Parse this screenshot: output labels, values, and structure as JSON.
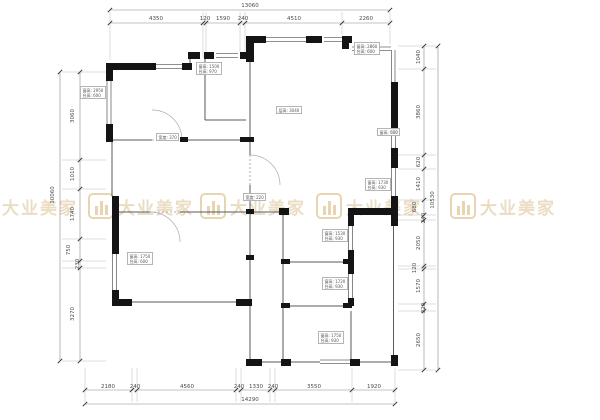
{
  "watermark": {
    "text": "大业美家",
    "color": "#dcc293"
  },
  "colors": {
    "walls": "#141414",
    "dimension_text": "#4a4a4a",
    "watermark": "#dcc293"
  },
  "dimensions": {
    "top": {
      "total": "13060",
      "segments": [
        "4350",
        "120",
        "1590",
        "240",
        "4510",
        "2260"
      ]
    },
    "bottom": {
      "total": "14290",
      "segments": [
        "2180",
        "240",
        "4560",
        "240",
        "1330",
        "240",
        "3550",
        "1920"
      ]
    },
    "left": {
      "total": "10060",
      "segments": [
        "3060",
        "1010",
        "1740",
        "750",
        "230",
        "3270"
      ]
    },
    "right": {
      "total": "10530",
      "segments": [
        "1040",
        "3860",
        "620",
        "1410",
        "680",
        "240",
        "2050",
        "120",
        "1570",
        "320",
        "2650"
      ]
    }
  },
  "annotations": [
    {
      "id": "window-left-upper",
      "lines": [
        "窗高: 2950",
        "台高: 600"
      ]
    },
    {
      "id": "window-top-middle",
      "lines": [
        "窗高: 1500",
        "台高: 970"
      ]
    },
    {
      "id": "window-top-right",
      "lines": [
        "窗高: 2860",
        "台高: 600"
      ]
    },
    {
      "id": "living-room-height",
      "lines": [
        "层高: 3040"
      ]
    },
    {
      "id": "window-right-upper",
      "lines": [
        "窗高: 600"
      ]
    },
    {
      "id": "opening-width-a",
      "lines": [
        "宽度: 370"
      ]
    },
    {
      "id": "opening-width-b",
      "lines": [
        "宽度: 220"
      ]
    },
    {
      "id": "window-right-mid",
      "lines": [
        "窗高: 1730",
        "台高: 930"
      ]
    },
    {
      "id": "window-bath-1",
      "lines": [
        "窗高: 1530",
        "台高: 930"
      ]
    },
    {
      "id": "window-bath-2",
      "lines": [
        "窗高: 1720",
        "台高: 930"
      ]
    },
    {
      "id": "window-bottom",
      "lines": [
        "窗高: 1750",
        "台高: 930"
      ]
    },
    {
      "id": "window-left-lower",
      "lines": [
        "窗高: 1750",
        "台高: 600"
      ]
    }
  ]
}
